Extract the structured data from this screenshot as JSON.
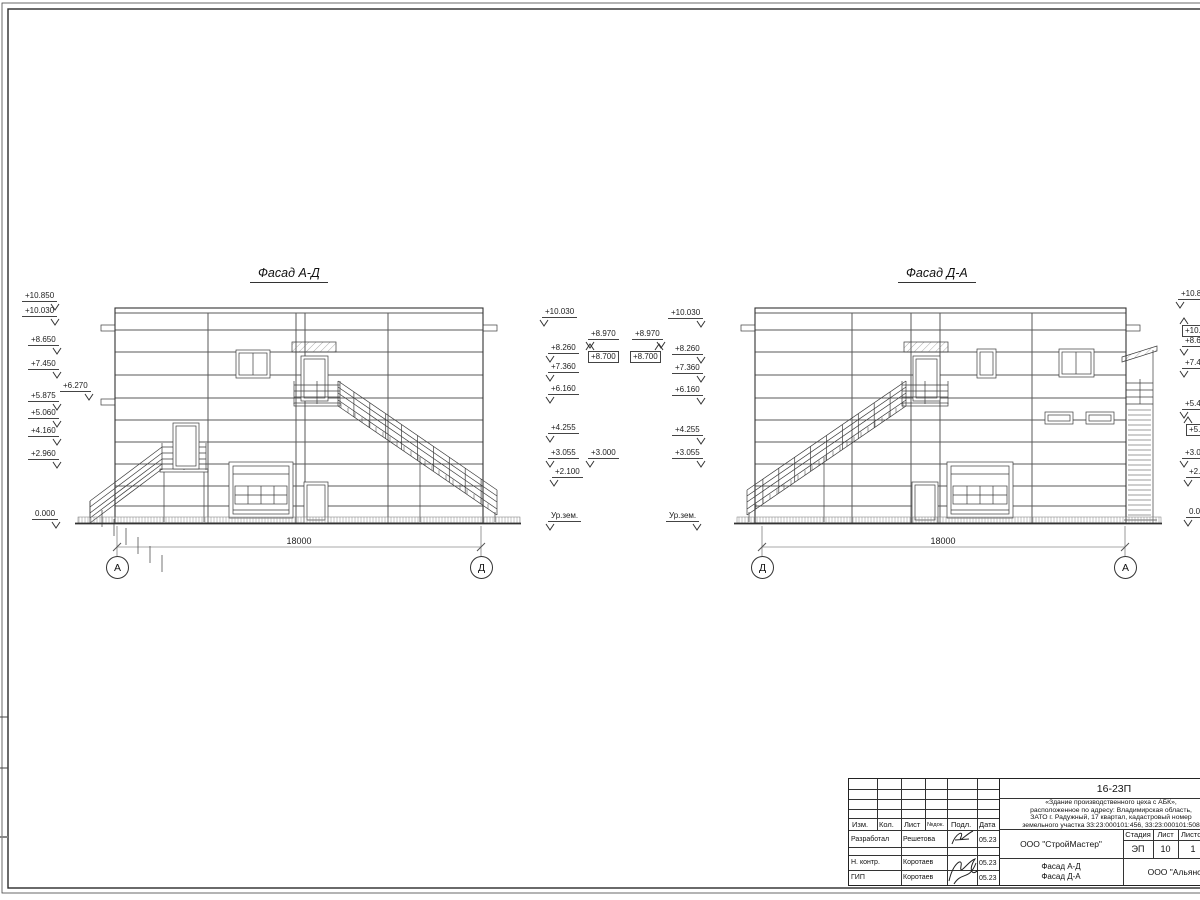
{
  "sheet": {
    "kind": "Фасады здания — чертёжный лист"
  },
  "facade1": {
    "title": "Фасад А-Д",
    "dimension": "18000",
    "axis_left": "А",
    "axis_right": "Д",
    "marks": [
      {
        "t": "+10.850",
        "x": 22,
        "y": 291,
        "side": "r"
      },
      {
        "t": "+10.030",
        "x": 22,
        "y": 306,
        "side": "r"
      },
      {
        "t": "+8.650",
        "x": 28,
        "y": 335,
        "side": "r"
      },
      {
        "t": "+7.450",
        "x": 28,
        "y": 359,
        "side": "r"
      },
      {
        "t": "+6.270",
        "x": 60,
        "y": 381,
        "side": "r"
      },
      {
        "t": "+5.875",
        "x": 28,
        "y": 391,
        "side": "r"
      },
      {
        "t": "+5.060",
        "x": 28,
        "y": 408,
        "side": "r"
      },
      {
        "t": "+4.160",
        "x": 28,
        "y": 426,
        "side": "r"
      },
      {
        "t": "+2.960",
        "x": 28,
        "y": 449,
        "side": "r"
      },
      {
        "t": "0.000",
        "x": 32,
        "y": 509,
        "side": "r"
      },
      {
        "t": "+10.030",
        "x": 542,
        "y": 307,
        "side": "l"
      },
      {
        "t": "+8.970",
        "x": 588,
        "y": 329,
        "side": "l"
      },
      {
        "t": "+8.700",
        "x": 588,
        "y": 351,
        "side": "l",
        "boxed": true,
        "up": true
      },
      {
        "t": "+8.260",
        "x": 548,
        "y": 343,
        "side": "l"
      },
      {
        "t": "+7.360",
        "x": 548,
        "y": 362,
        "side": "l"
      },
      {
        "t": "+6.160",
        "x": 548,
        "y": 384,
        "side": "l"
      },
      {
        "t": "+4.255",
        "x": 548,
        "y": 423,
        "side": "l"
      },
      {
        "t": "+3.055",
        "x": 548,
        "y": 448,
        "side": "l"
      },
      {
        "t": "+3.000",
        "x": 588,
        "y": 448,
        "side": "l"
      },
      {
        "t": "+2.100",
        "x": 552,
        "y": 467,
        "side": "l"
      },
      {
        "t": "Ур.зем.",
        "x": 548,
        "y": 511,
        "side": "l"
      }
    ]
  },
  "facade2": {
    "title": "Фасад Д-А",
    "dimension": "18000",
    "axis_left": "Д",
    "axis_right": "А",
    "marks": [
      {
        "t": "+8.970",
        "x": 632,
        "y": 329,
        "side": "r"
      },
      {
        "t": "+8.700",
        "x": 630,
        "y": 351,
        "side": "r",
        "boxed": true,
        "up": true
      },
      {
        "t": "+10.030",
        "x": 668,
        "y": 308,
        "side": "r"
      },
      {
        "t": "+8.260",
        "x": 672,
        "y": 344,
        "side": "r"
      },
      {
        "t": "+7.360",
        "x": 672,
        "y": 363,
        "side": "r"
      },
      {
        "t": "+6.160",
        "x": 672,
        "y": 385,
        "side": "r"
      },
      {
        "t": "+4.255",
        "x": 672,
        "y": 425,
        "side": "r"
      },
      {
        "t": "+3.055",
        "x": 672,
        "y": 448,
        "side": "r"
      },
      {
        "t": "Ур.зем.",
        "x": 666,
        "y": 511,
        "side": "r"
      },
      {
        "t": "+10.8",
        "x": 1178,
        "y": 289,
        "side": "l"
      },
      {
        "t": "+10.0",
        "x": 1182,
        "y": 325,
        "side": "l",
        "boxed": true,
        "up": true
      },
      {
        "t": "+8.65",
        "x": 1182,
        "y": 336,
        "side": "l"
      },
      {
        "t": "+7.45",
        "x": 1182,
        "y": 358,
        "side": "l"
      },
      {
        "t": "+5.48",
        "x": 1182,
        "y": 399,
        "side": "l"
      },
      {
        "t": "+5.08",
        "x": 1186,
        "y": 424,
        "side": "l",
        "boxed": true,
        "up": true
      },
      {
        "t": "+3.00",
        "x": 1182,
        "y": 448,
        "side": "l"
      },
      {
        "t": "+2.10",
        "x": 1186,
        "y": 467,
        "side": "l"
      },
      {
        "t": "0.00",
        "x": 1186,
        "y": 507,
        "side": "l"
      }
    ]
  },
  "titleblock": {
    "doc_number": "16-23П",
    "description_lines": [
      "«Здание производственного цеха с АБК»,",
      "расположенное по адресу: Владимирская область,",
      "ЗАТО г. Радужный, 17 квартал, кадастровый номер",
      "земельного участка 33:23:000101:456, 33:23:000101:508"
    ],
    "headers": {
      "izm": "Изм.",
      "kol": "Кол.",
      "list": "Лист",
      "ndok": "№док.",
      "podp": "Подл.",
      "date": "Дата"
    },
    "roles": [
      {
        "role": "Разработал",
        "name": "Решетова",
        "date": "05.23"
      },
      {
        "role": "Н. контр.",
        "name": "Коротаев",
        "date": "05.23"
      },
      {
        "role": "ГИП",
        "name": "Коротаев",
        "date": "05.23"
      }
    ],
    "org": "ООО \"СтройМастер\"",
    "client": "ООО \"Альянс\"",
    "stage_label": "Стадия",
    "sheet_label": "Лист",
    "sheets_label": "Листов",
    "stage": "ЭП",
    "sheet_no": "10",
    "sheets_total": "1",
    "title_line1": "Фасад А-Д",
    "title_line2": "Фасад Д-А"
  }
}
